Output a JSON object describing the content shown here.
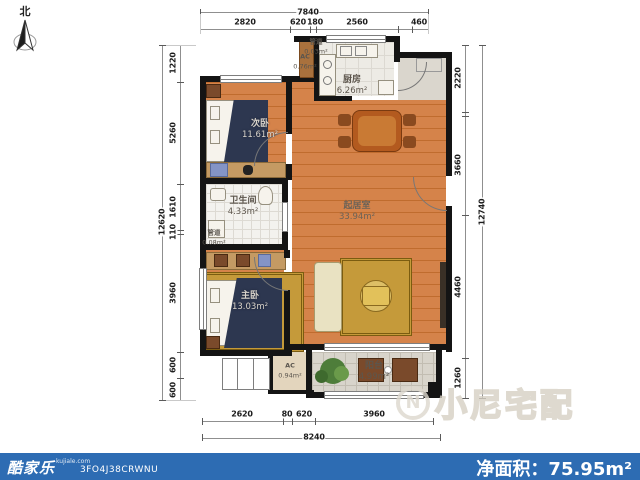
{
  "compass": {
    "label": "北"
  },
  "rooms": {
    "bed2": {
      "name": "次卧",
      "area": "11.61m²"
    },
    "kitchen": {
      "name": "厨房",
      "area": "6.26m²"
    },
    "bath": {
      "name": "卫生间",
      "area": "4.33m²"
    },
    "living": {
      "name": "起居室",
      "area": "33.94m²"
    },
    "master": {
      "name": "主卧",
      "area": "13.03m²"
    },
    "balcony": {
      "name": "阳台",
      "area": "4.99m²"
    },
    "duct_top": {
      "name": "管道",
      "area": "0.03m²"
    },
    "ac_top": {
      "name": "AC",
      "area": "0.76m²"
    },
    "duct_mid": {
      "name": "管道",
      "area": "0.08m²"
    },
    "ac_bottom": {
      "name": "AC",
      "area": "0.94m²"
    }
  },
  "dimensions": {
    "top": {
      "total": "7840",
      "segments": [
        "2820",
        "620",
        "180",
        "2560",
        "460"
      ]
    },
    "left": {
      "total": "12620",
      "segments": [
        "1220",
        "5260",
        "1610",
        "110",
        "3960",
        "600",
        "600"
      ]
    },
    "right": {
      "total": "12740",
      "segments": [
        "2220",
        "3660",
        "4460",
        "1260"
      ]
    },
    "bottom": {
      "total": "8240",
      "segments": [
        "2620",
        "80",
        "620",
        "3960"
      ]
    }
  },
  "watermark": {
    "text": "小尼宅配",
    "logo": "N"
  },
  "footer": {
    "brand": "酷家乐",
    "brand_domain": "kujiale.com",
    "plan_code": "3FO4J38CRWNU",
    "net_area_label": "净面积：",
    "net_area_value": "75.95",
    "net_area_unit": "m²"
  },
  "colors": {
    "footer_blue": "#2d6cb3",
    "wood": "#d2803f",
    "wall": "#141414",
    "gold": "#c59a3a"
  }
}
